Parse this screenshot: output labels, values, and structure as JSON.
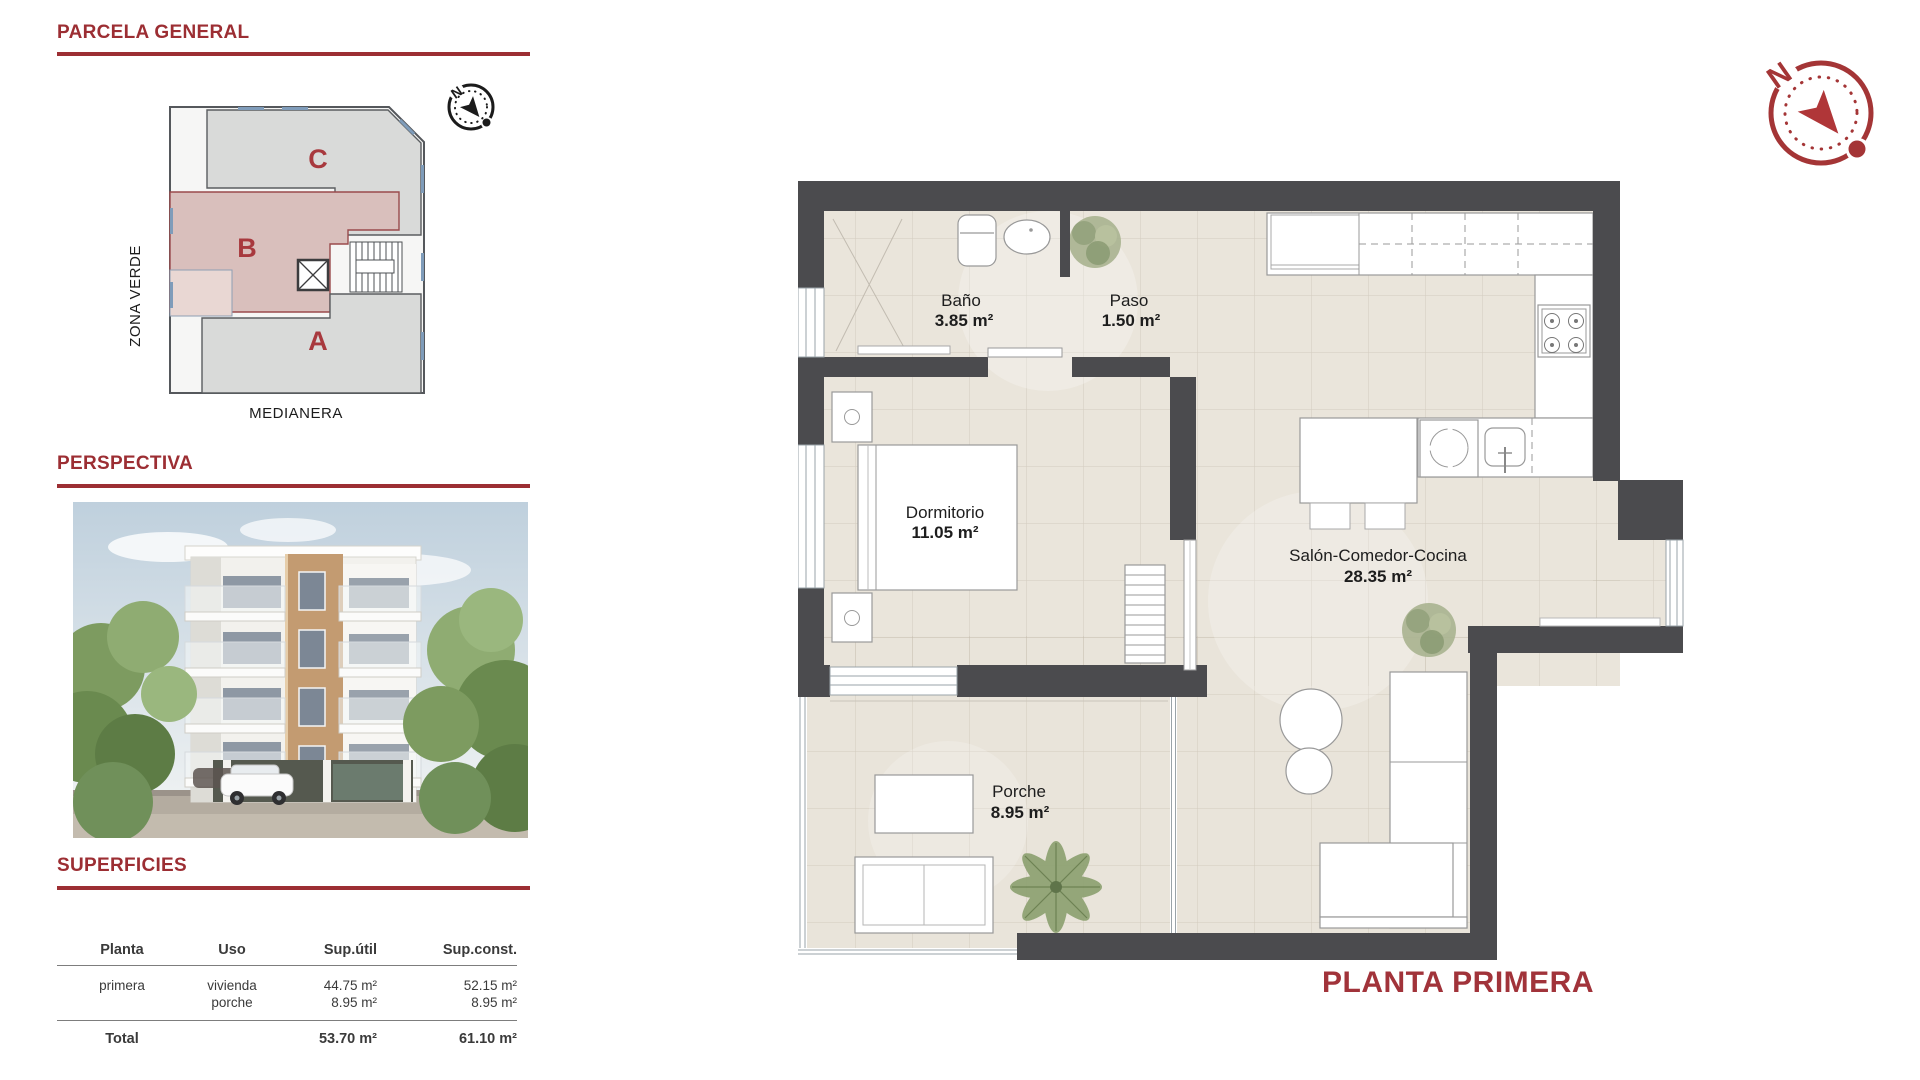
{
  "colors": {
    "accent_red": "#9c2e33",
    "title_red": "#a1333a",
    "wall_gray": "#4b4b4e",
    "floor_beige": "#eae5db",
    "zone_b_pink": "#d9bfbc",
    "zone_gray": "#dcdcdc"
  },
  "sidebar": {
    "parcela": {
      "title": "PARCELA GENERAL",
      "zone_c": "C",
      "zone_b": "B",
      "zone_a": "A",
      "left_label": "ZONA VERDE",
      "bottom_label": "MEDIANERA",
      "compass_letter": "N"
    },
    "perspectiva": {
      "title": "PERSPECTIVA"
    },
    "superficies": {
      "title": "SUPERFICIES",
      "headers": {
        "planta": "Planta",
        "uso": "Uso",
        "sup_util": "Sup.útil",
        "sup_const": "Sup.const."
      },
      "row": {
        "planta": "primera",
        "uso1": "vivienda",
        "uso2": "porche",
        "util1": "44.75 m²",
        "util2": "8.95 m²",
        "const1": "52.15 m²",
        "const2": "8.95 m²"
      },
      "total": {
        "label": "Total",
        "util": "53.70 m²",
        "const": "61.10 m²"
      }
    }
  },
  "floorplan": {
    "title": "PLANTA PRIMERA",
    "compass_letter": "N",
    "rooms": {
      "bano": {
        "name": "Baño",
        "area": "3.85 m²"
      },
      "paso": {
        "name": "Paso",
        "area": "1.50 m²"
      },
      "dormitorio": {
        "name": "Dormitorio",
        "area": "11.05 m²"
      },
      "salon": {
        "name": "Salón-Comedor-Cocina",
        "area": "28.35 m²"
      },
      "porche": {
        "name": "Porche",
        "area": "8.95 m²"
      }
    }
  }
}
